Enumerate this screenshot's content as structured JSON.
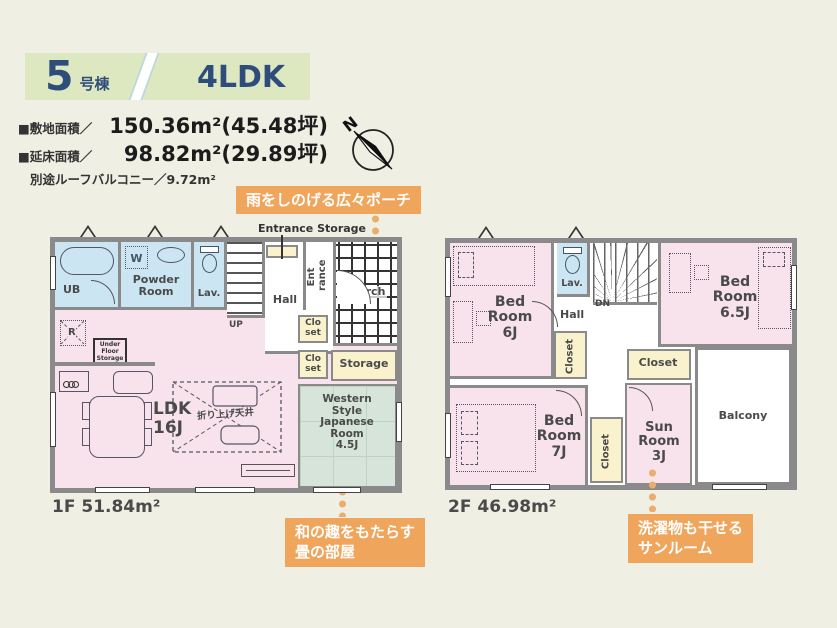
{
  "header": {
    "unit_number": "5",
    "unit_suffix": "号棟",
    "layout_type": "4LDK"
  },
  "site_info": {
    "land_label": "■敷地面積／",
    "land_value": "150.36m²(45.48坪)",
    "floor_label": "■延床面積／",
    "floor_value": "98.82m²(29.89坪)",
    "roof_balcony": "別途ルーフバルコニー／9.72m²"
  },
  "compass": {
    "north": "N"
  },
  "callouts": {
    "porch": "雨をしのげる広々ポーチ",
    "tatami": "和の趣をもたらす\n畳の部屋",
    "sunroom": "洗濯物も干せる\nサンルーム"
  },
  "floor1": {
    "area_label": "1F 51.84m²",
    "ub": "UB",
    "washer": "W",
    "powder_room": "Powder\nRoom",
    "lav": "Lav.",
    "up": "UP",
    "hall": "Hall",
    "entrance_storage": "Entrance Storage",
    "entrance": "Ent\nrance",
    "porch": "Porch",
    "fridge": "R",
    "under_floor_storage": "Under\nFloor\nStorage",
    "closet_a": "Clo\nset",
    "closet_b": "Clo\nset",
    "storage": "Storage",
    "ldk": "LDK\n16J",
    "raised_ceiling": "折り上げ天井",
    "japanese_room": "Western\nStyle\nJapanese\nRoom\n4.5J"
  },
  "floor2": {
    "area_label": "2F 46.98m²",
    "bedroom_6": "Bed\nRoom\n6J",
    "lav": "Lav.",
    "dn": "DN",
    "hall": "Hall",
    "bedroom_65": "Bed\nRoom\n6.5J",
    "closet_a": "Closet",
    "closet_b": "Closet",
    "closet_c": "Closet",
    "bedroom_7": "Bed\nRoom\n7J",
    "sunroom": "Sun\nRoom\n3J",
    "balcony": "Balcony"
  }
}
